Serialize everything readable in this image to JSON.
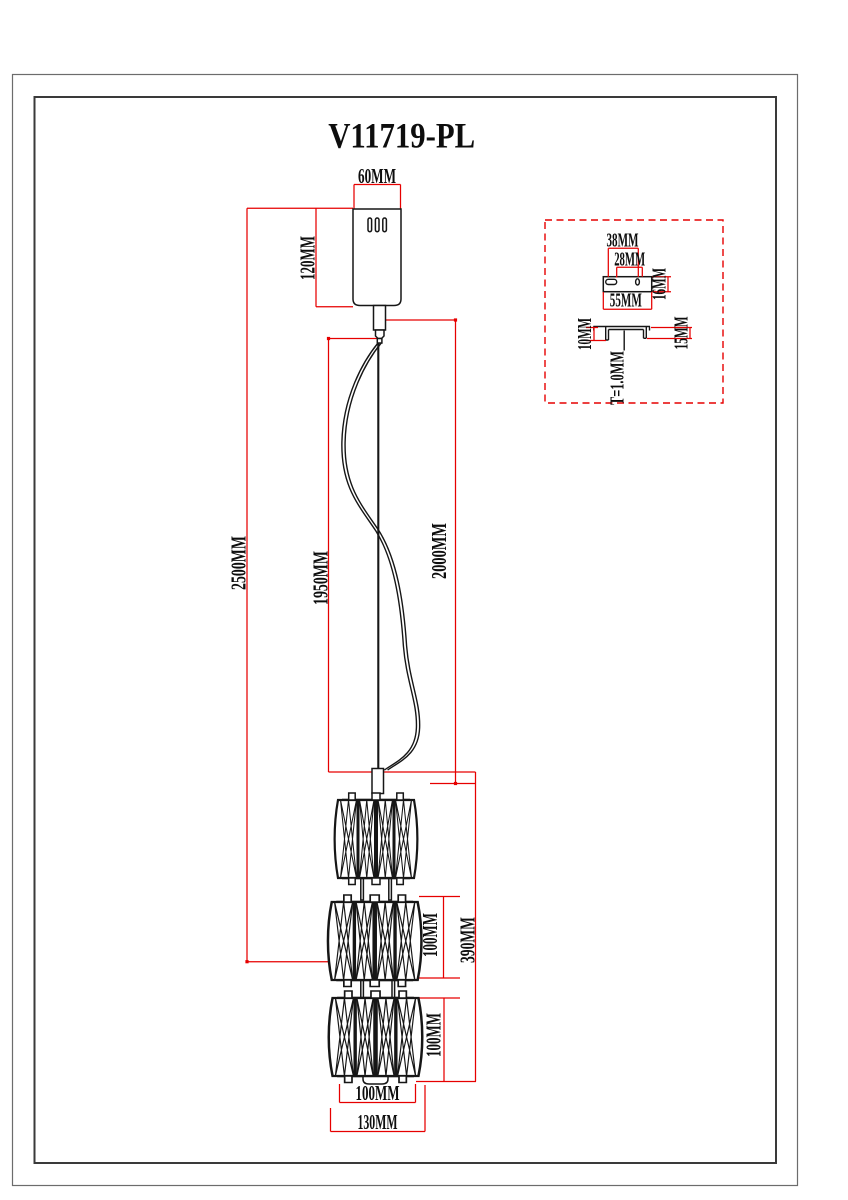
{
  "title": "V11719-PL",
  "colors": {
    "dimension_lines": "#e60000",
    "drawing_lines": "#161616",
    "background": "#ffffff"
  },
  "dims": {
    "canopy_width": "60MM",
    "canopy_height": "120MM",
    "overall_drop": "2500MM",
    "wire_drop": "1950MM",
    "cord_drop": "2000MM",
    "shade_stack_height": "390MM",
    "shade2_height": "100MM",
    "shade3_height": "100MM",
    "shade_diameter": "100MM",
    "shade_max_diameter": "130MM"
  },
  "detail": {
    "hole_spacing": "38MM",
    "slot_span": "28MM",
    "plate_depth": "16MM",
    "plate_width": "55MM",
    "left_flange_height": "10MM",
    "right_flange_height": "15MM",
    "plate_thickness": "T=1.0MM"
  }
}
